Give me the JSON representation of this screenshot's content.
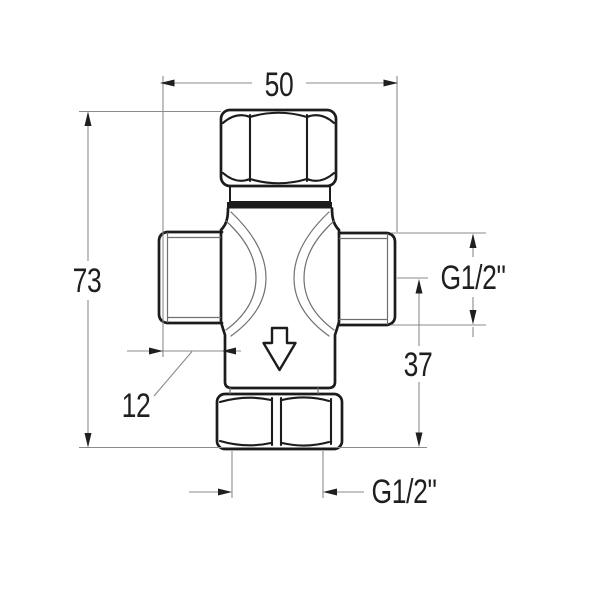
{
  "colors": {
    "background": "#ffffff",
    "outline": "#1c1c1c",
    "detail_line": "#6f6f6f",
    "dimension_line": "#8b8b8b",
    "annotation": "#1f1f1f"
  },
  "dimensions": {
    "overall_width": "50",
    "overall_height": "73",
    "side_port_length": "12",
    "side_thread_size": "G1/2\"",
    "outlet_center_to_base": "37",
    "bottom_thread_size": "G1/2\""
  },
  "flow_arrow": {
    "direction": "down"
  }
}
